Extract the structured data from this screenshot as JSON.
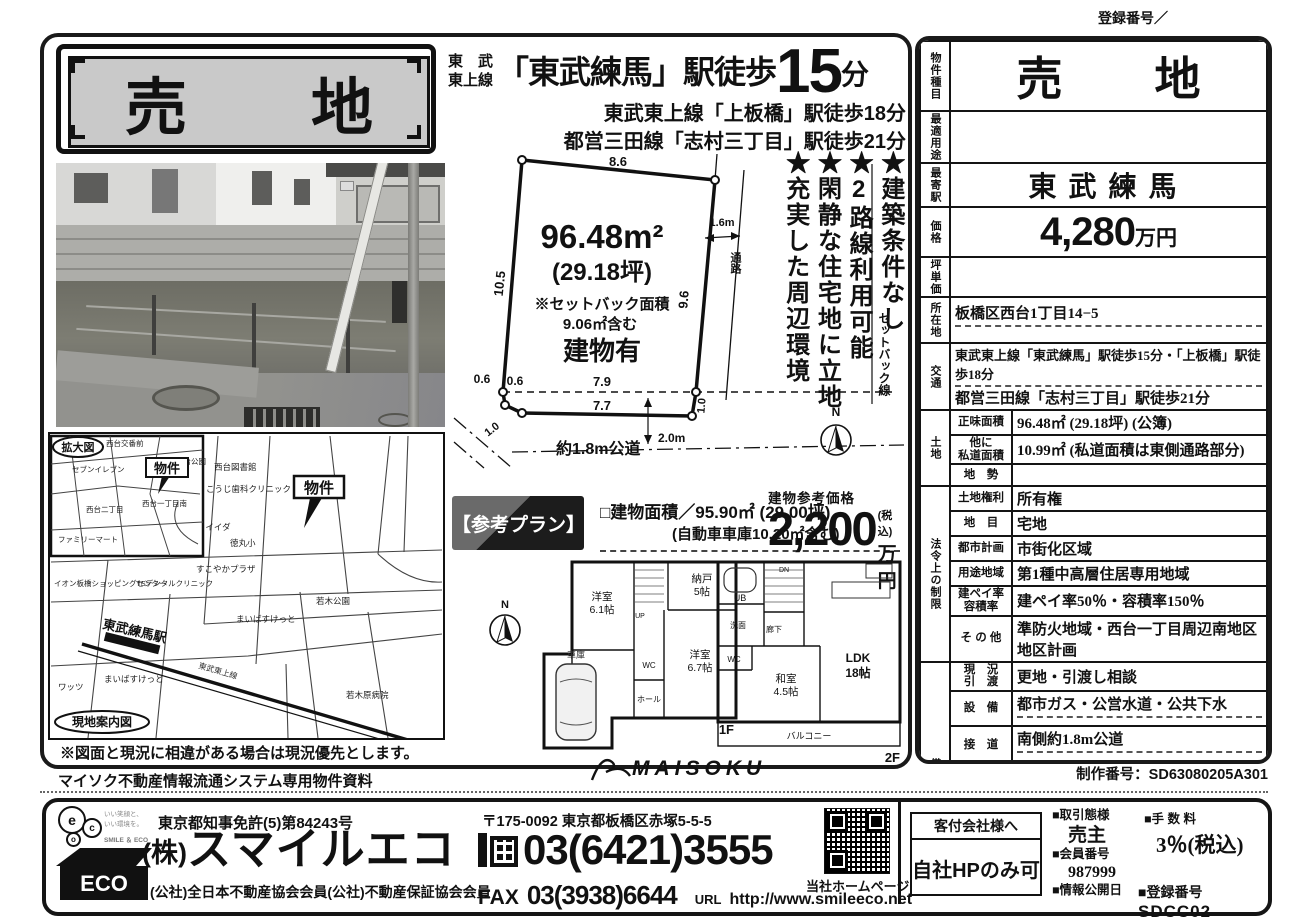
{
  "meta": {
    "reg_top": "登録番号／",
    "production_no": "制作番号：SD63080205A301",
    "maisoku_note": "マイソク不動産情報流通システム専用物件資料",
    "maisoku_logo": "MAISOKU",
    "discrepancy_note": "※図面と現況に相違がある場合は現況優先とします。"
  },
  "banner": {
    "title": "売　　地"
  },
  "header": {
    "line_small": "東　武\n東上線",
    "station_main": "「東武練馬」駅徒歩",
    "minutes": "15",
    "minutes_unit": "分",
    "sub1": "東武東上線「上板橋」駅徒歩18分",
    "sub2": "都営三田線「志村三丁目」駅徒歩21分"
  },
  "features": {
    "f1": "★建築条件なし",
    "f2": "★2路線利用可能",
    "f3": "★閑静な住宅地に立地",
    "f4": "★充実した周辺環境"
  },
  "plot": {
    "area_main": "96.48m²",
    "area_tsubo": "(29.18坪)",
    "setback1": "※セットバック面積",
    "setback2": "9.06㎡含む",
    "building": "建物有",
    "dim_top": "8.6",
    "dim_left": "10.5",
    "dim_right": "9.6",
    "dim_dashed": "7.9",
    "dim_bottom": "7.7",
    "dim_c1": "0.6",
    "dim_c2": "0.6",
    "dim_lb": "1.0",
    "dim_rb": "1.0",
    "passage_w": "1.6m",
    "passage": "通路",
    "setback_line": "セットバック線",
    "road": "約1.8m公道",
    "road_w": "2.0m",
    "north": "N"
  },
  "plan": {
    "badge": "【参考プラン】",
    "area": "□建物面積／95.90㎡ (29.00坪)",
    "area_sub": "(自動車車庫10.20㎡含む)",
    "price_label": "建物参考価格",
    "price": "2,200",
    "tax": "(税込)",
    "unit": "万円"
  },
  "floor1": {
    "label": "1F",
    "r1a": "洋室",
    "r1b": "6.1帖",
    "r2a": "納戸",
    "r2b": "5帖",
    "r3a": "洋室",
    "r3b": "6.7帖",
    "wc": "WC",
    "hall": "ホール",
    "garage": "車庫",
    "up": "UP"
  },
  "floor2": {
    "label": "2F",
    "ub": "UB",
    "dn": "DN",
    "hall": "廊下",
    "wash": "洗面",
    "wc": "WC",
    "w1": "和室",
    "w2": "4.5帖",
    "l1": "LDK",
    "l2": "18帖",
    "balcony": "バルコニー"
  },
  "maps": {
    "inset_title": "拡大図",
    "guide_title": "現地案内図",
    "property": "物件",
    "i1": "西台交番前",
    "i2": "セブンイレブン",
    "i3": "西台二丁目",
    "i4": "ファミリーマート",
    "i5": "西台一丁目南",
    "i6": "西台公園",
    "m1": "西台図書館",
    "m2": "こうじ歯科クリニック",
    "m3": "コモディイイダ",
    "m4": "西徳第一公園",
    "m5": "すこやかプラザ",
    "m6": "イオン板橋ショッピングセンター",
    "m7": "TSデンタルクリニック",
    "m8": "東武練馬駅",
    "m9": "まいばすけっと",
    "m10": "ワッツ",
    "m11": "若木公園",
    "m12": "徳丸小",
    "m13": "まいばすけっと",
    "m14": "若木原病院",
    "m15": "東武東上線"
  },
  "table": {
    "r1_label": "物件種目",
    "r1_value": "売　　地",
    "r2_label": "最適用途",
    "r2_value": "",
    "r3_label": "最寄駅",
    "r3_value": "東武練馬",
    "r4_label": "価格",
    "r4_num": "4,280",
    "r4_unit": "万円",
    "r5_label": "坪単価",
    "r5_value": "",
    "r6_label": "所在地",
    "r6_value": "板橋区西台1丁目14−5",
    "r7_label": "交通",
    "r7_line1": "東武東上線「東武練馬」駅徒歩15分・「上板橋」駅徒歩18分",
    "r7_line2": "都営三田線「志村三丁目」駅徒歩21分",
    "g1_label": "土地",
    "g1r1_sub": "正味面積",
    "g1r1_val": "96.48㎡ (29.18坪) (公簿)",
    "g1r2_sub": "他に\n私道面積",
    "g1r2_val": "10.99㎡ (私道面積は東側通路部分)",
    "g1r3_sub": "地　勢",
    "g1r3_val": "",
    "g2_label": "法令上の制限",
    "g2r1_sub": "土地権利",
    "g2r1_val": "所有権",
    "g2r2_sub": "地　目",
    "g2r2_val": "宅地",
    "g2r3_sub": "都市計画",
    "g2r3_val": "市街化区域",
    "g2r4_sub": "用途地域",
    "g2r4_val": "第1種中高層住居専用地域",
    "g2r5_sub": "建ペイ率\n容積率",
    "g2r5_val": "建ペイ率50％・容積率150％",
    "g2r6_sub": "そ の 他",
    "g2r6_val": "準防火地域・西台一丁目周辺南地区地区計画",
    "g3_label": "備考",
    "g3r1_sub": "現　況\n引　渡",
    "g3r1_val": "更地・引渡し相談",
    "g3r2_sub": "設　備",
    "g3r2_val": "都市ガス・公営水道・公共下水",
    "g3r3_sub": "接　道",
    "g3r3_val": "南側約1.8m公道",
    "g3r4_sub": "そ の 他",
    "g3r4_val": "土地面積にセットバック部分9.06㎡含む(現況図による)\n確定測量実施中\n更地"
  },
  "footer": {
    "license": "東京都知事免許(5)第84243号",
    "company_mark": "(株)",
    "company_name": "スマイルエコ",
    "membership": "(公社)全日本不動産協会会員(公社)不動産保証協会会員",
    "address": "〒175-0092 東京都板橋区赤塚5-5-5",
    "tel": "03(6421)3555",
    "fax_label": "FAX",
    "fax": "03(3938)6644",
    "url_label": "URL",
    "url": "http://www.smileeco.net",
    "qr_caption": "当社ホームページ",
    "kyaku_header": "客付会社様へ",
    "kyaku_value": "自社HPのみ可",
    "deal_label": "■取引態様",
    "deal": "売主",
    "member_label": "■会員番号",
    "member_no": "987999",
    "info_label": "■情報公開日",
    "fee_label": "■手 数 料",
    "fee": "3％(税込)",
    "reg_label": "■登録番号",
    "reg_no": "SDCC02",
    "logo_b1": "e",
    "logo_b2": "c",
    "logo_b3": "o",
    "logo_tagline": "いい笑顔と、\nいい環境を。",
    "logo_smile": "SMILE ＆ ECO",
    "logo_house": "ECO"
  }
}
